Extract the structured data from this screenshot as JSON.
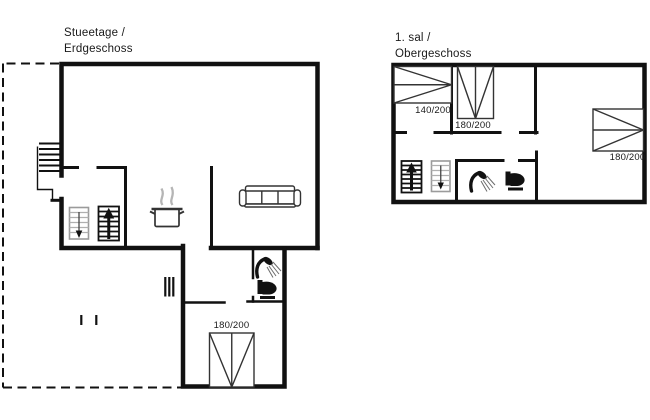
{
  "ground_floor": {
    "title_line1": "Stueetage /",
    "title_line2": "Erdgeschoss",
    "bed_labels": {
      "bedroom": "180/200"
    }
  },
  "upper_floor": {
    "title_line1": "1. sal /",
    "title_line2": "Obergeschoss",
    "bed_labels": {
      "bed_140": "140/200",
      "bed_180_top": "180/200",
      "bed_180_right": "180/200"
    }
  },
  "colors": {
    "wall": "#111111",
    "furniture_outline": "#333333",
    "light_stair": "#9b9b9b",
    "steam": "#b5b5b5",
    "text": "#1a1a1a",
    "background": "#ffffff"
  },
  "icons": [
    "stairs-up-icon",
    "stairs-down-icon",
    "shower-icon",
    "toilet-icon",
    "stove-pot-icon",
    "sofa-icon",
    "double-bed-icon",
    "entrance-steps-icon",
    "vent-icon"
  ]
}
